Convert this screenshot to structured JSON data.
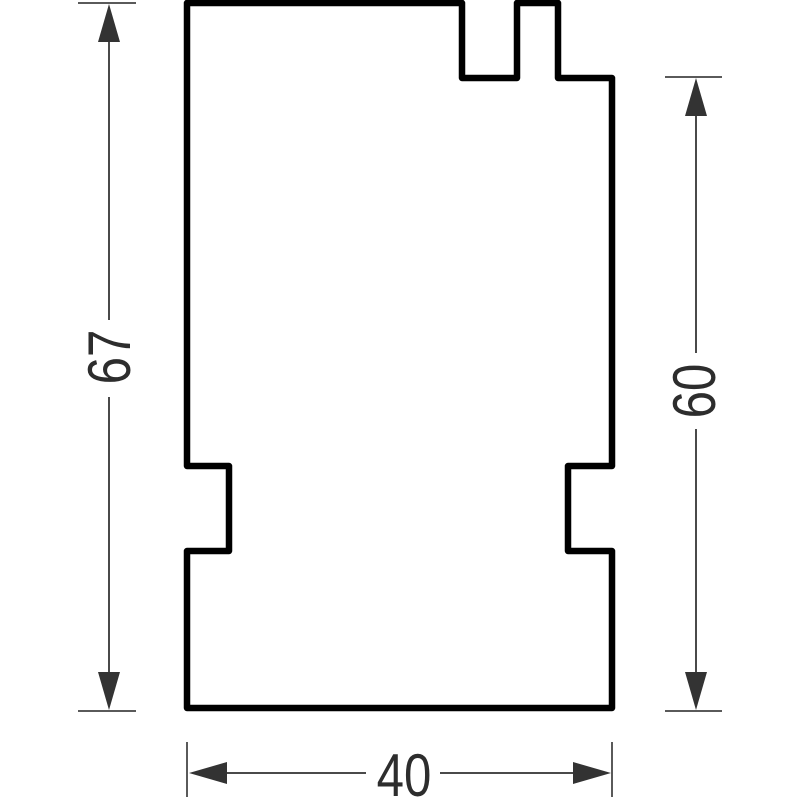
{
  "drawing": {
    "type": "technical-part-profile",
    "part": {
      "outline_path": "M 187 3 H 462 V 78 H 517 V 3 H 558 V 78 H 612 V 466 H 568 V 551 H 612 V 708 H 187 V 551 H 229 V 466 H 187 Z",
      "fill": "#ffffff",
      "outline_color": "#000000"
    },
    "dimensions": {
      "left_height": {
        "value": "67",
        "orientation": "vertical"
      },
      "right_height": {
        "value": "60",
        "orientation": "vertical"
      },
      "bottom_width": {
        "value": "40",
        "orientation": "horizontal"
      }
    },
    "colors": {
      "outline": "#000000",
      "dimension_line": "#4a4a4a",
      "extension_line": "#5a5a5a",
      "arrow": "#333333",
      "label_text": "#2d2d2d",
      "background": "#ffffff"
    }
  }
}
